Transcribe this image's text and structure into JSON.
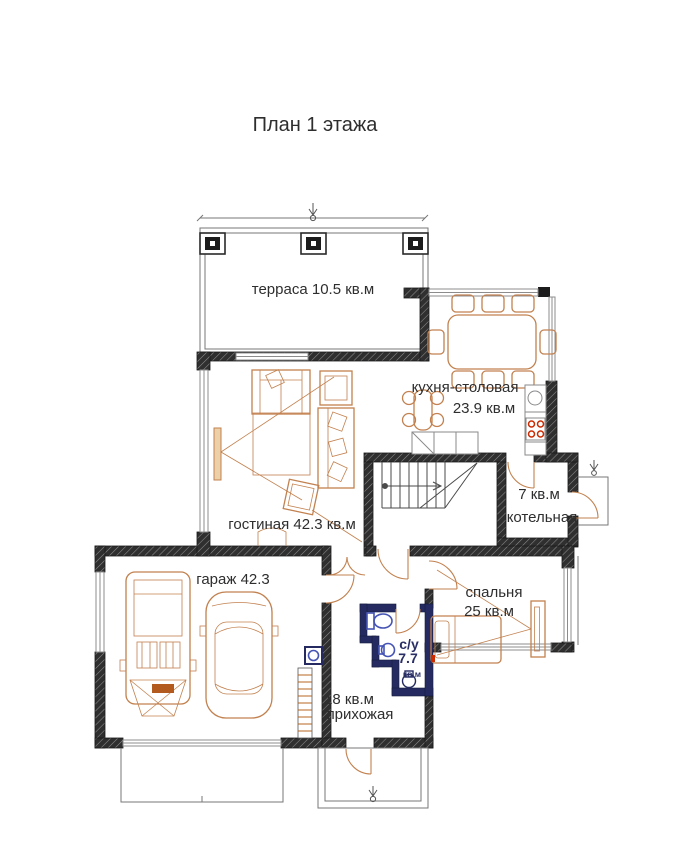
{
  "title": "План 1 этажа",
  "rooms": {
    "terrace": {
      "label": "терраса 10.5 кв.м"
    },
    "kitchen_dining": {
      "name": "кухня-столовая",
      "area": "23.9 кв.м"
    },
    "boiler": {
      "area": "7 кв.м",
      "name": "котельная"
    },
    "living": {
      "label": "гостиная 42.3 кв.м"
    },
    "garage": {
      "label": "гараж 42.3"
    },
    "bedroom": {
      "name": "спальня",
      "area": "25 кв.м"
    },
    "wc": {
      "name": "с/у",
      "area": "7.7",
      "unit": "кв.м"
    },
    "hall": {
      "area": "18 кв.м",
      "name": "прихожая"
    }
  },
  "colors": {
    "wall": "#2f2f2f",
    "furniture": "#c2814f",
    "plumbing": "#4553b4",
    "bath_wall": "#252b60",
    "stove_burner": "#cc2a00"
  }
}
